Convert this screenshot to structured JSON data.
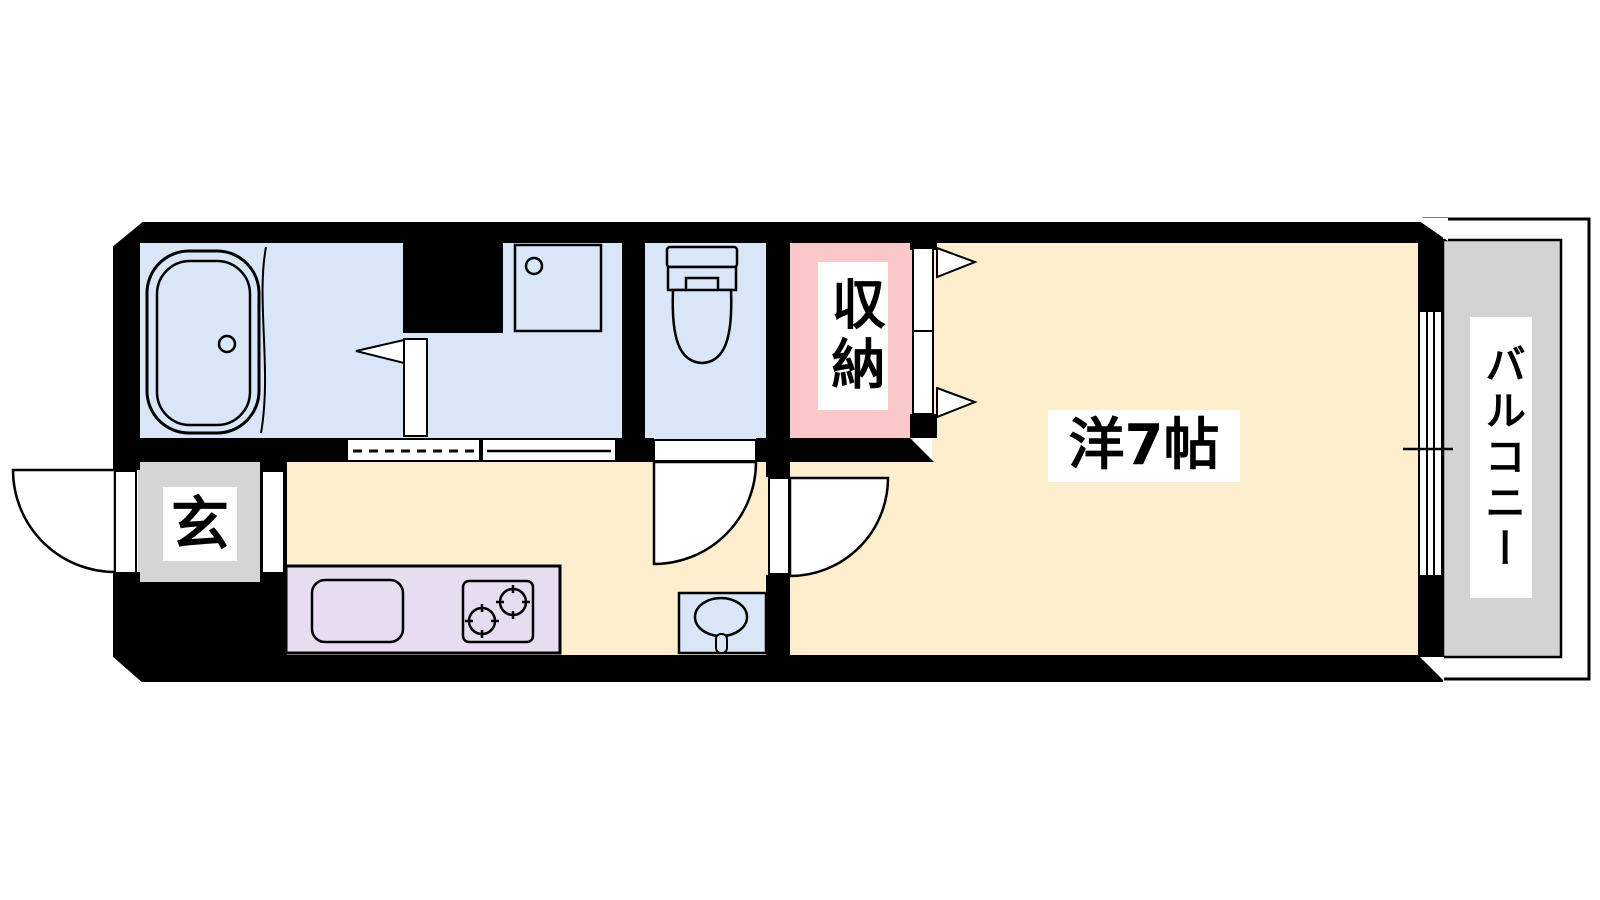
{
  "floor_plan": {
    "labels": {
      "entrance": "玄",
      "closet": "収納",
      "western_room": "洋7帖",
      "balcony": "バルコニー"
    },
    "colors": {
      "wall": "#000000",
      "wet_area": "#d9e6f8",
      "flooring": "#fdeecd",
      "closet": "#fac8c8",
      "entrance": "#d5d5d5",
      "balcony": "#d3d3d3",
      "kitchen_counter": "#e7dcf0",
      "door_white": "#ffffff",
      "line": "#000000"
    }
  }
}
